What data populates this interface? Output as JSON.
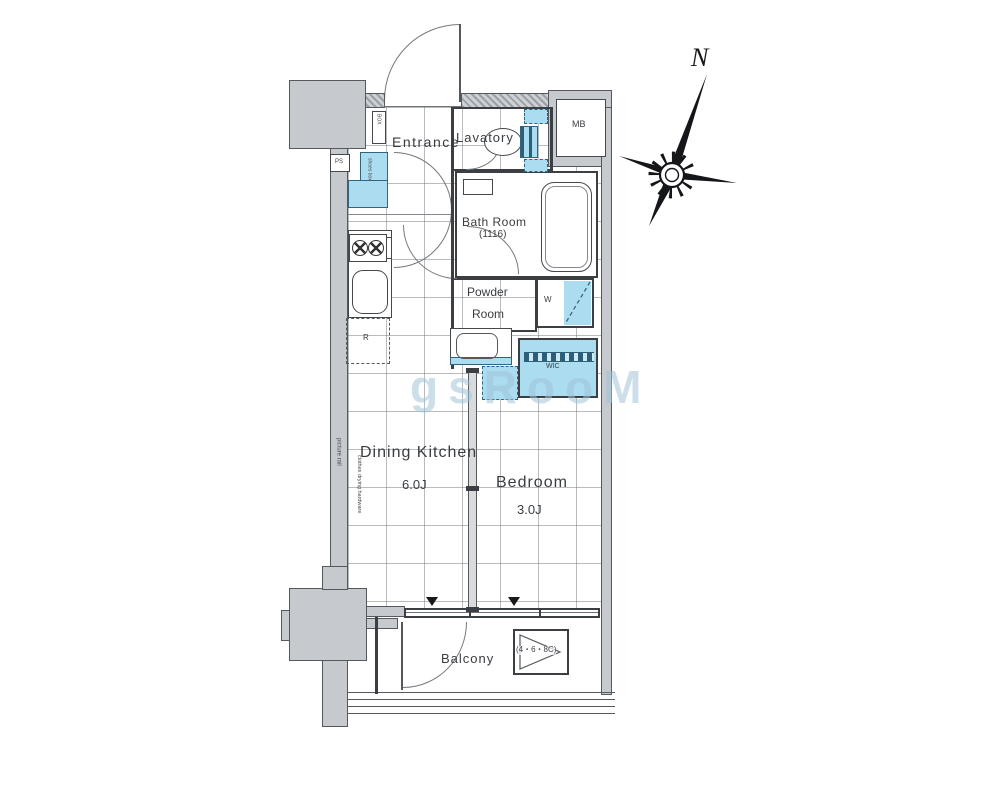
{
  "plan": {
    "rooms": {
      "entrance": "Entrance",
      "lavatory": "Lavatory",
      "bath_room": "Bath Room",
      "bath_size": "(1116)",
      "powder_line1": "Powder",
      "powder_line2": "Room",
      "dining_kitchen": "Dining Kitchen",
      "dining_kitchen_size": "6.0J",
      "bedroom": "Bedroom",
      "bedroom_size": "3.0J",
      "balcony": "Balcony"
    },
    "annotations": {
      "mb": "MB",
      "ps": "PS",
      "delivery_box": "BOX",
      "shoes_box": "shoes box",
      "washer": "W",
      "wic": "WIC",
      "refrigerator": "R",
      "picture_rail": "picture rail",
      "clothes_drying": "clothes drying hardware",
      "escape_hatch": "(4・6・8C)",
      "north": "N"
    },
    "watermark": "gsRooM",
    "colors": {
      "water_blue": "#abdcef",
      "structure_gray": "#c6cacf",
      "wall_dark": "#3b3f43",
      "grid_gray": "#9aa0a6"
    }
  }
}
